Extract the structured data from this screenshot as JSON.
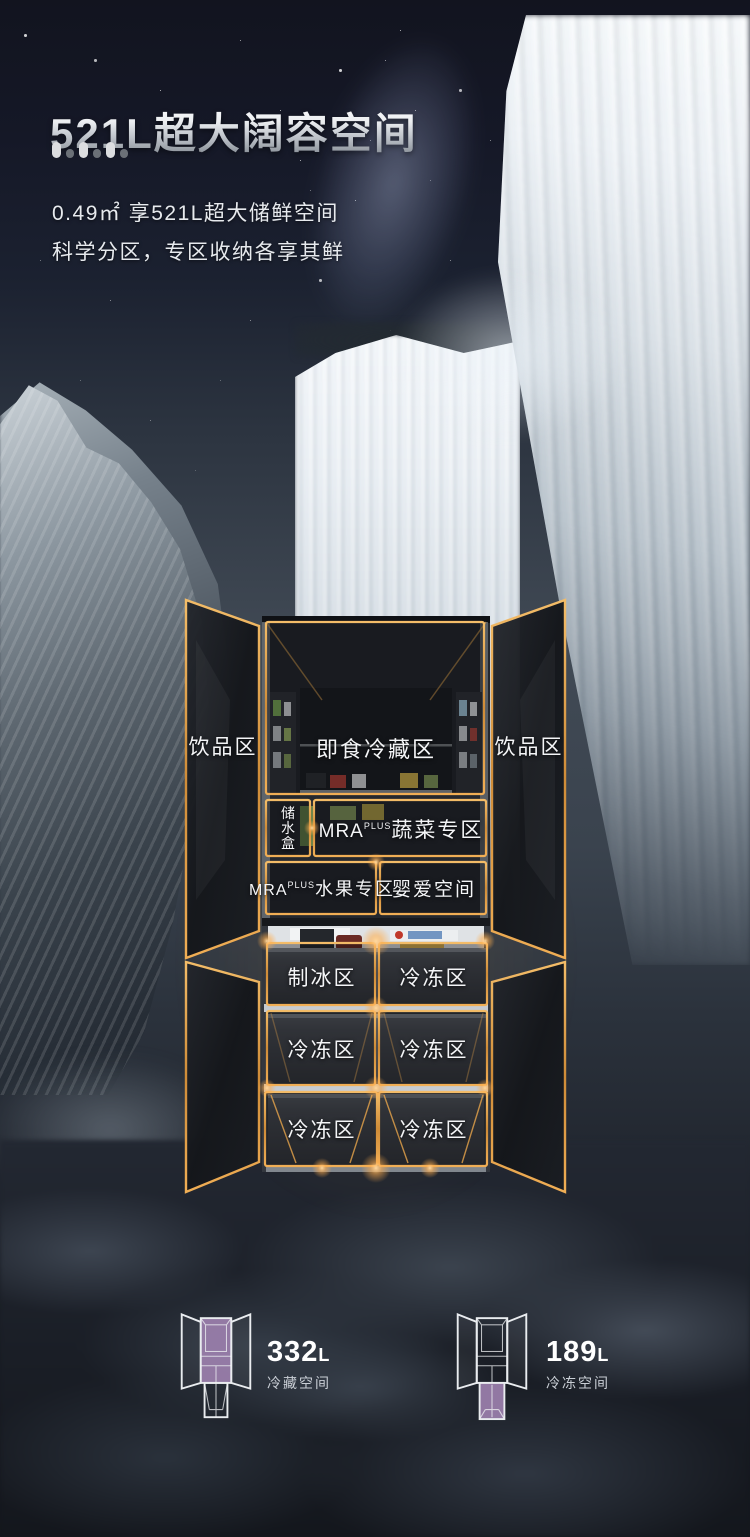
{
  "header": {
    "title": "521L超大阔容空间",
    "subtitle_line1": "0.49㎡ 享521L超大储鲜空间",
    "subtitle_line2": "科学分区，专区收纳各享其鲜"
  },
  "colors": {
    "gold_outline": "#e9a84e",
    "highlight_purple": "#9c80ae",
    "text_white": "#f4f5f7"
  },
  "fridge": {
    "door_left_label": "饮品区",
    "door_right_label": "饮品区",
    "zones": {
      "chilled": "即食冷藏区",
      "water_box": "储水盒",
      "mra_prefix": "MRA",
      "mra_sup": "PLUS",
      "veg": "蔬菜专区",
      "fruit": "水果专区",
      "baby": "婴爱空间",
      "ice": "制冰区"
    },
    "freezer_labels": [
      "冷冻区",
      "冷冻区",
      "冷冻区",
      "冷冻区",
      "冷冻区"
    ]
  },
  "stats": [
    {
      "icon": "fridge-top-highlight-icon",
      "value": "332",
      "unit": "L",
      "label": "冷藏空间"
    },
    {
      "icon": "fridge-bottom-highlight-icon",
      "value": "189",
      "unit": "L",
      "label": "冷冻空间"
    }
  ]
}
